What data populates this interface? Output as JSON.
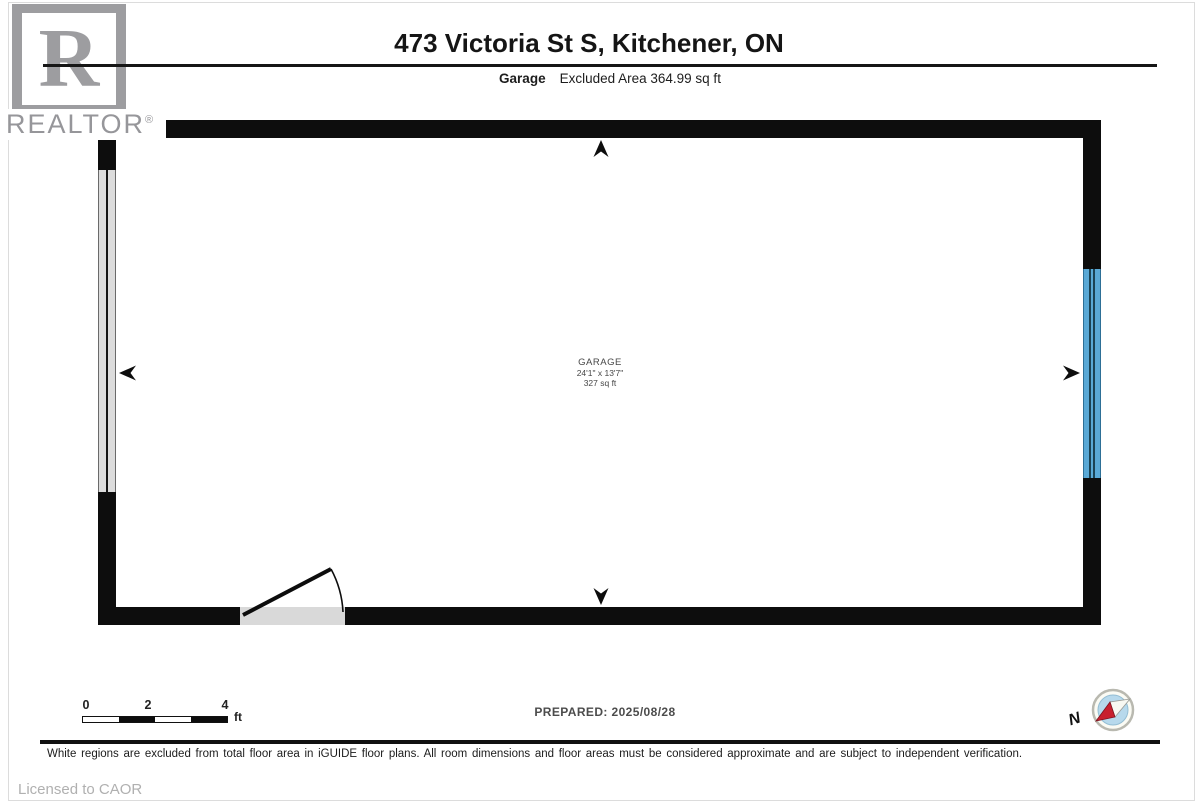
{
  "header": {
    "logo_letter": "R",
    "brand": "REALTOR",
    "registered": "®",
    "title": "473 Victoria St S, Kitchener, ON",
    "floor_label": "Garage",
    "excluded_area": "Excluded Area 364.99 sq ft"
  },
  "plan": {
    "room": {
      "name": "GARAGE",
      "dimensions": "24'1\" x 13'7\"",
      "area": "327 sq ft"
    }
  },
  "scale_bar": {
    "ticks": [
      "0",
      "2",
      "4"
    ],
    "unit": "ft"
  },
  "footer": {
    "prepared": "PREPARED: 2025/08/28",
    "compass_label": "N",
    "disclaimer": "White regions are excluded from total floor area in iGUIDE floor plans. All room dimensions and floor areas must be considered approximate and are subject to independent verification.",
    "licensed": "Licensed to CAOR"
  },
  "colors": {
    "wall": "#0d0d0d",
    "window_gray": "#dcdcdc",
    "door_blue": "#5aa9d6",
    "compass_red": "#c8202f",
    "compass_blue": "#b7d9ec"
  }
}
